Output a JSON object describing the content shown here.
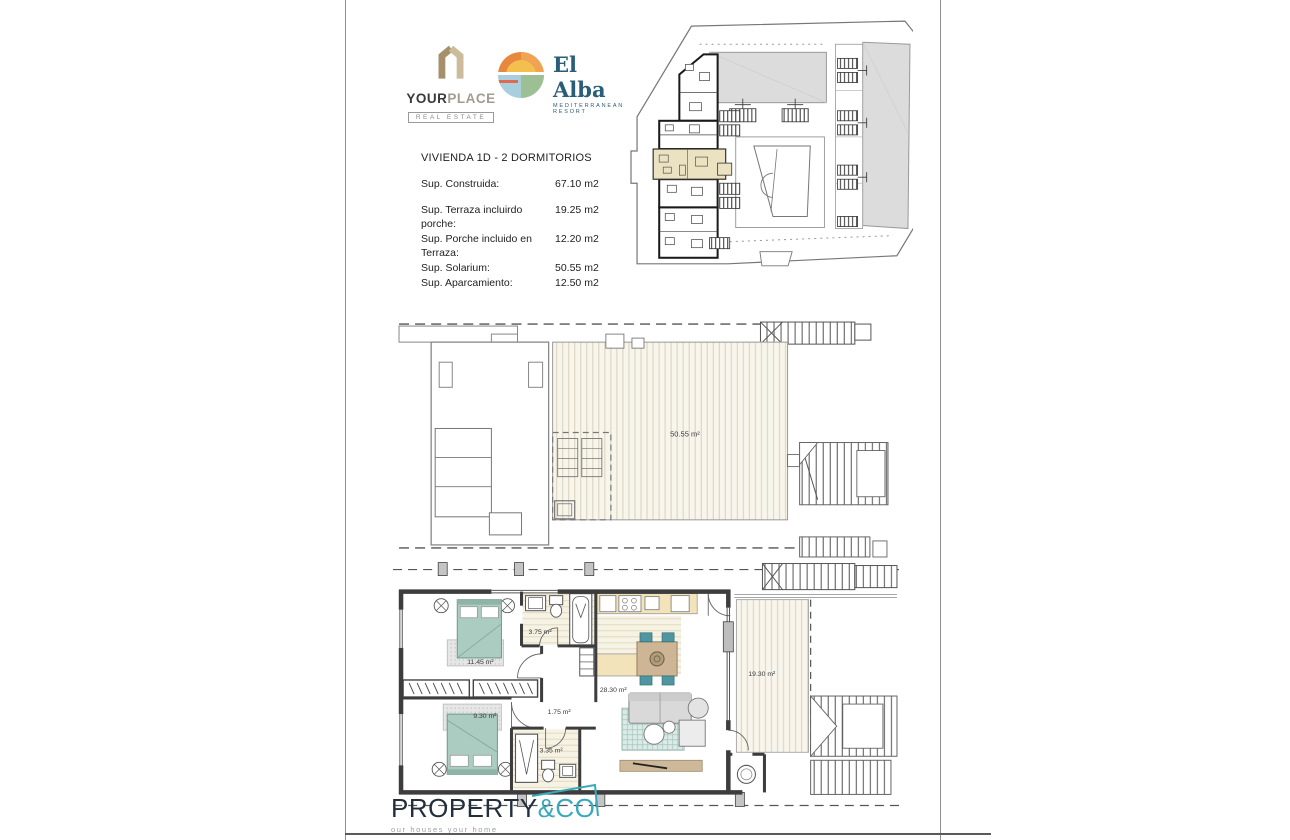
{
  "header": {
    "yourplace": {
      "word1": "YOUR",
      "word2": "PLACE",
      "subtitle": "REAL ESTATE"
    },
    "elalba": {
      "name": "El Alba",
      "subtitle": "MEDITERRANEAN RESORT"
    }
  },
  "info": {
    "title": "VIVIENDA  1D - 2 DORMITORIOS",
    "construida": {
      "label": "Sup. Construida:",
      "value": "67.10 m2"
    },
    "rows": [
      {
        "label": "Sup. Terraza incluirdo porche:",
        "value": "19.25 m2"
      },
      {
        "label": "Sup. Porche incluido en Terraza:",
        "value": "12.20 m2"
      },
      {
        "label": "Sup. Solarium:",
        "value": "50.55 m2"
      },
      {
        "label": "Sup. Aparcamiento:",
        "value": "12.50 m2"
      }
    ]
  },
  "plans": {
    "solarium": {
      "area": "50.55 m²"
    },
    "apartment": {
      "bath1": "3.75 m²",
      "bed1": "11.45 m²",
      "living": "28.30 m²",
      "hall": "1.75 m²",
      "bed2": "9.30 m²",
      "bath2": "3.35 m²",
      "terrace": "19.30 m²"
    }
  },
  "footer": {
    "brand1": "PROPERTY",
    "brand2": "&CO",
    "tagline": "our houses your home"
  },
  "colors": {
    "yourplace_tan": "#b3a07c",
    "elalba_blue": "#2a5d78",
    "elalba_orange": "#e8873e",
    "elalba_yellow": "#f3c04f",
    "propertyco_teal": "#3aa9b9",
    "propertyco_navy": "#232f3b",
    "highlight_unit_beige": "#ebe2c2",
    "building_gray": "#dcdcdc",
    "bed_teal": "#abccc1",
    "kitchen_counter_cream": "#f3e3ba",
    "deck_cream": "#f8f5ec",
    "wall_dark": "#3d3d3d"
  }
}
